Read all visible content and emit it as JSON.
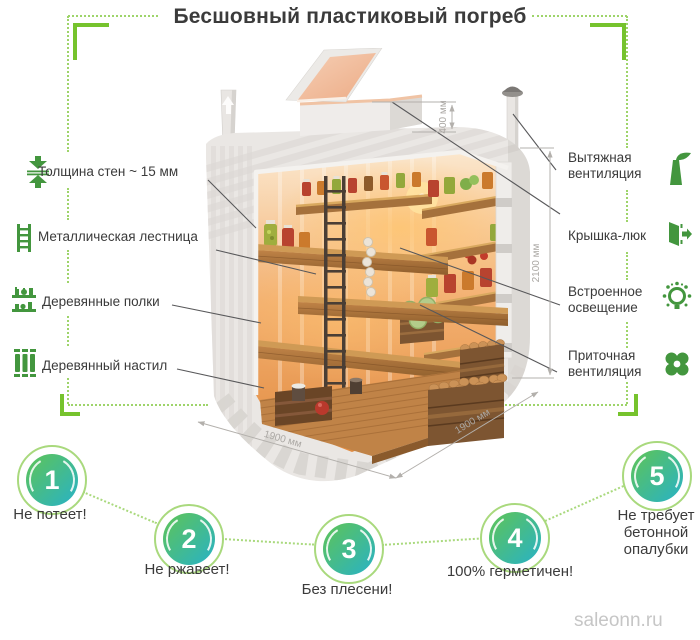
{
  "title": "Бесшовный пластиковый погреб",
  "watermark": "saleonn.ru",
  "left_callouts": [
    {
      "label": "Толщина стен ~ 15 мм",
      "icon": "wall-thickness-icon"
    },
    {
      "label": "Металлическая лестница",
      "icon": "metal-ladder-icon"
    },
    {
      "label": "Деревянные полки",
      "icon": "wooden-shelves-icon"
    },
    {
      "label": "Деревянный настил",
      "icon": "wooden-decking-icon"
    }
  ],
  "right_callouts": [
    {
      "label": "Вытяжная вентиляция",
      "icon": "exhaust-vent-icon"
    },
    {
      "label": "Крышка-люк",
      "icon": "hatch-lid-icon"
    },
    {
      "label": "Встроенное освещение",
      "icon": "built-in-light-icon"
    },
    {
      "label": "Приточная вентиляция",
      "icon": "supply-vent-icon"
    }
  ],
  "dimensions": {
    "hatch_height": "400 мм",
    "inner_height": "2100 мм",
    "width": "1900 мм",
    "depth": "1900 мм"
  },
  "benefits": [
    {
      "number": "1",
      "label": "Не потеет!"
    },
    {
      "number": "2",
      "label": "Не ржавеет!"
    },
    {
      "number": "3",
      "label": "Без плесени!"
    },
    {
      "number": "4",
      "label": "100% герметичен!"
    },
    {
      "number": "5",
      "label": "Не требует бетонной опалубки"
    }
  ],
  "colors": {
    "accent_green": "#76c32d",
    "frame_green": "#9ed46a",
    "icon_green": "#43963e",
    "badge_ring": "#a9d97d",
    "badge_grad_1": "#5fc455",
    "badge_grad_2": "#28b2c7",
    "text_dark": "#3b3b3b",
    "dim_gray": "#b3b0ac",
    "leader_gray": "#58585a",
    "watermark_gray": "#c6c6c6"
  }
}
